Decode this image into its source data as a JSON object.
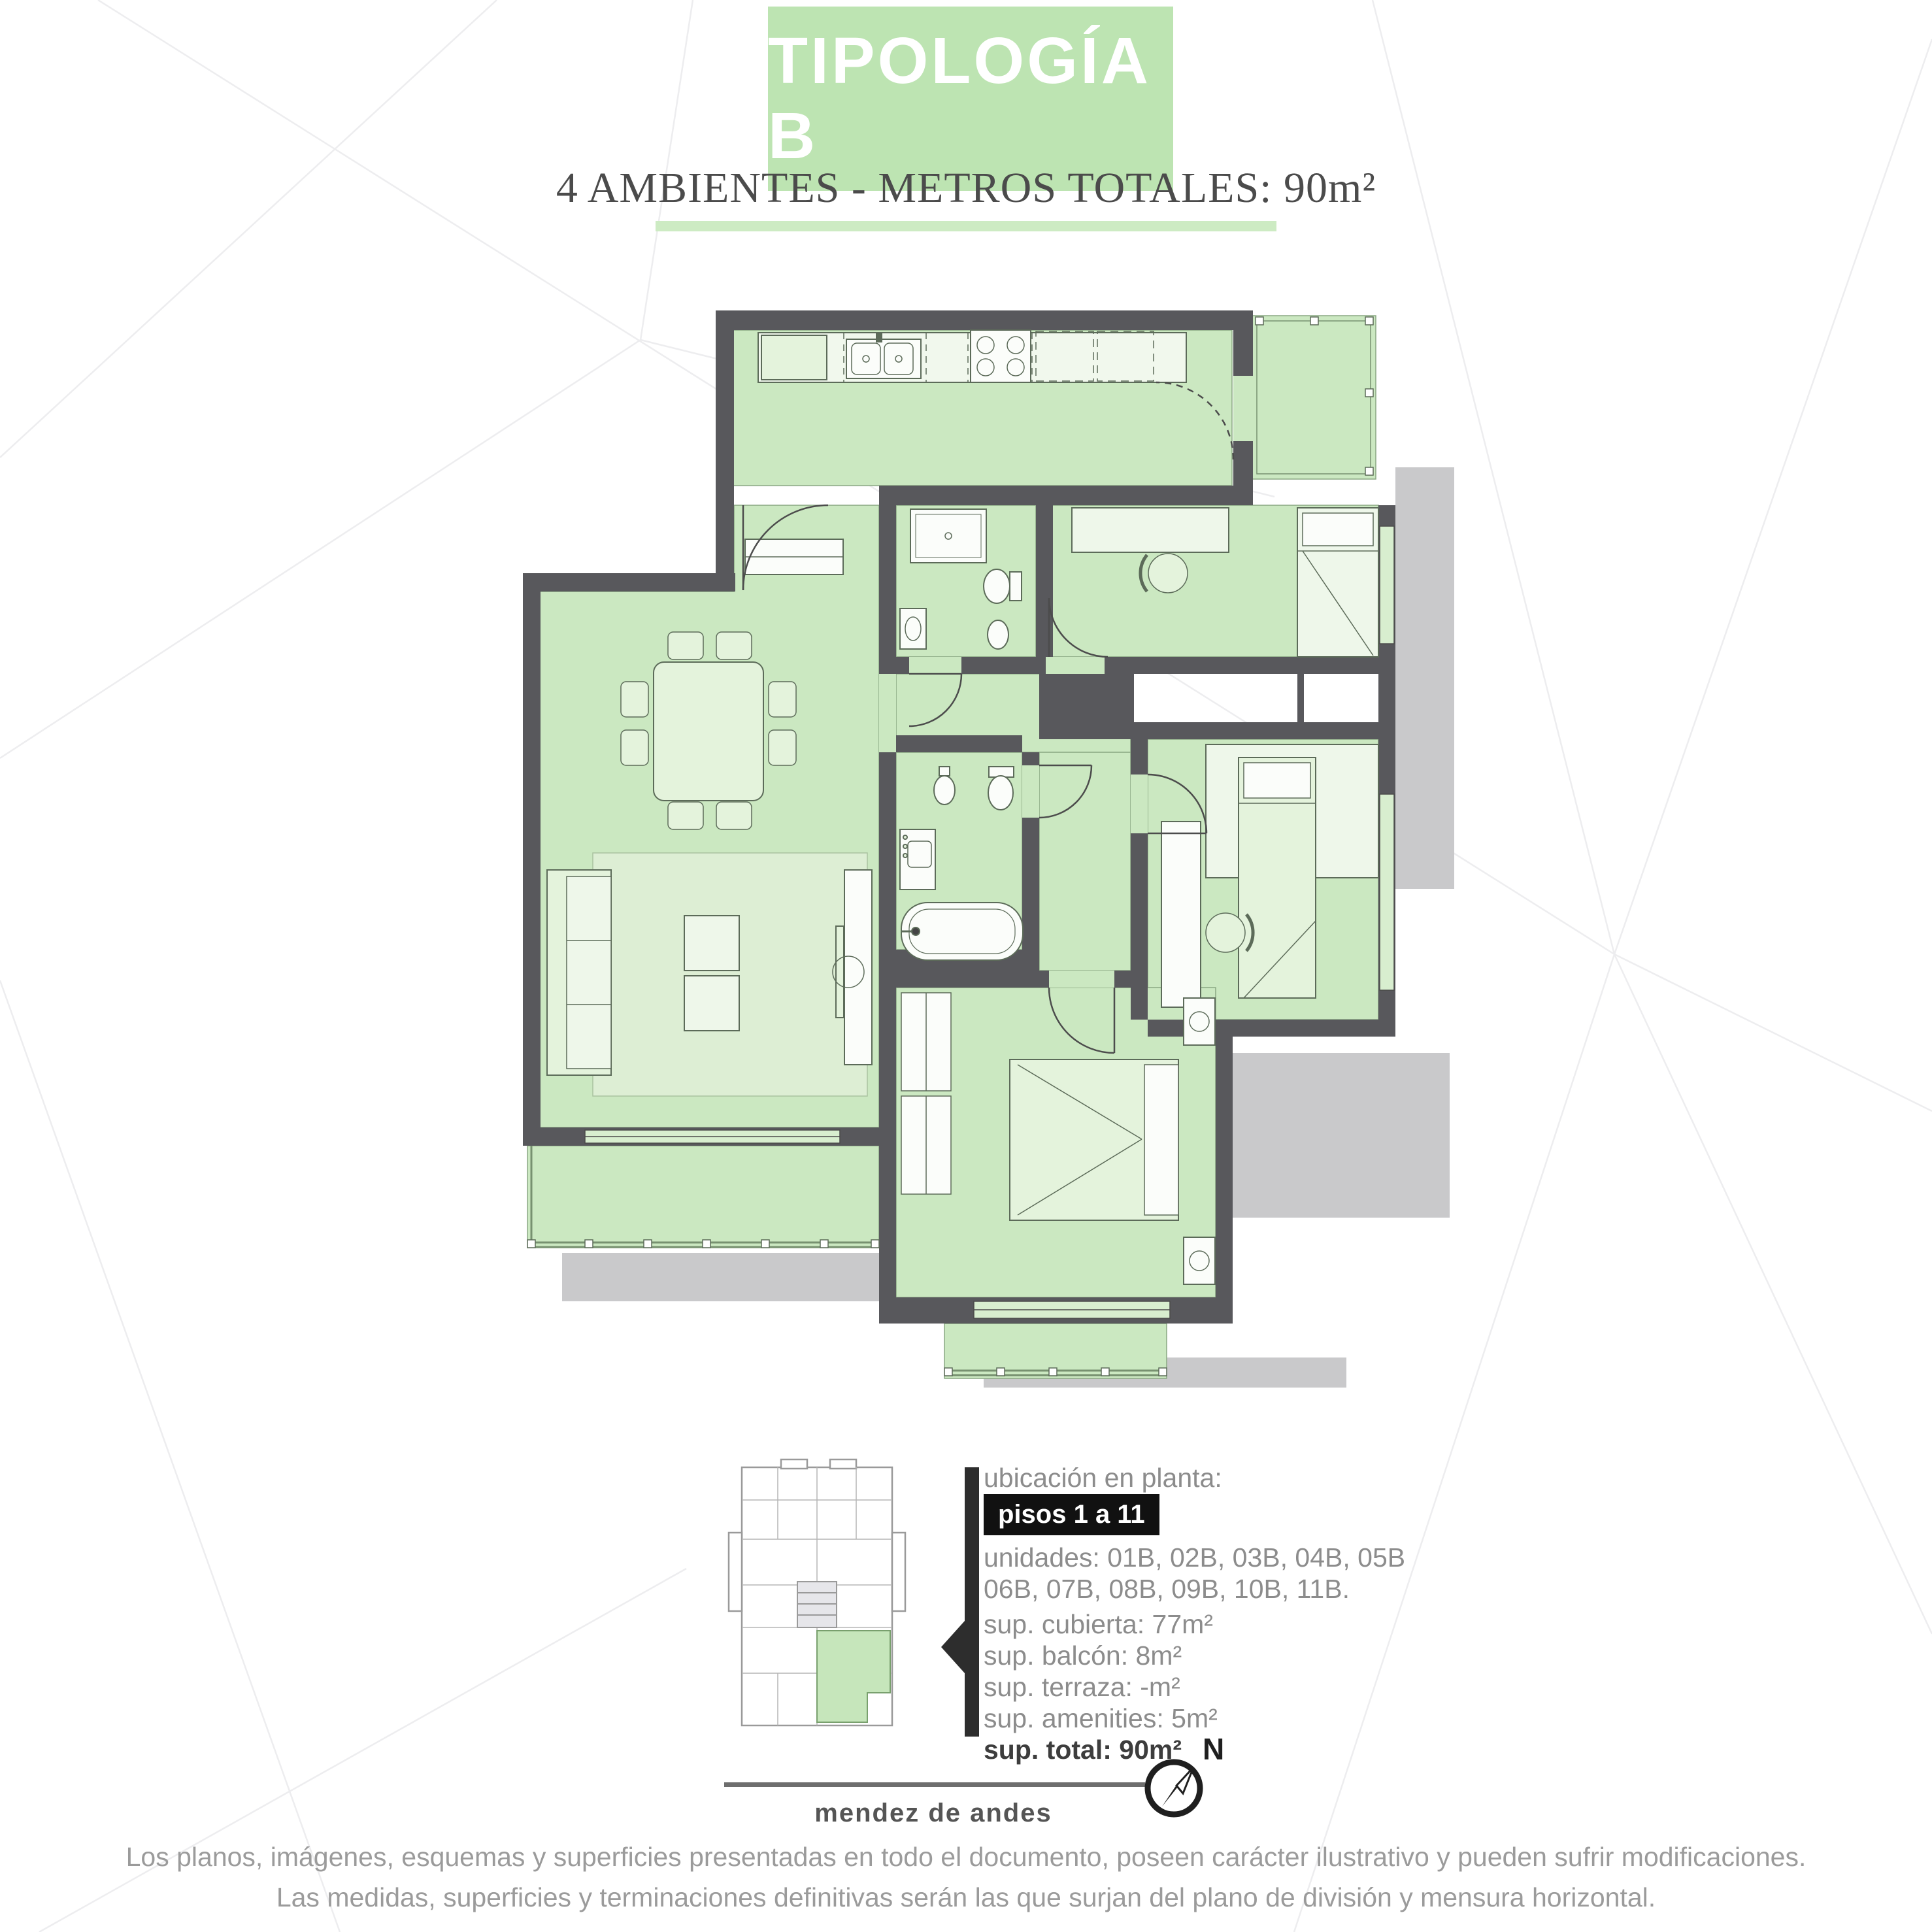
{
  "header": {
    "title": "TIPOLOGÍA B",
    "subtitle": "4 AMBIENTES - METROS TOTALES: 90m²"
  },
  "location": {
    "label": "ubicación en planta:",
    "floors_badge": "pisos 1 a 11",
    "units_line1": "unidades: 01B, 02B, 03B, 04B, 05B",
    "units_line2": "06B, 07B, 08B, 09B, 10B, 11B.",
    "surfaces": {
      "cubierta": "sup. cubierta: 77m²",
      "balcon": "sup. balcón: 8m²",
      "terraza": "sup. terraza: -m²",
      "amenities": "sup. amenities: 5m²",
      "total": "sup. total: 90m²"
    },
    "street_label": "mendez de andes",
    "compass_north_label": "N"
  },
  "disclaimer": {
    "line1": "Los planos, imágenes, esquemas y superficies presentadas en todo el documento, poseen carácter ilustrativo y pueden sufrir modificaciones.",
    "line2": "Las medidas, superficies y terminaciones definitivas serán las que surjan del plano de división y mensura horizontal."
  },
  "colors": {
    "accent_green": "#bde4b2",
    "underline_green": "#cdebc3",
    "room_green": "#cbe8c1",
    "furniture_green": "#e4f3dc",
    "wall_gray": "#58585c",
    "shadow_gray": "#c9c9cb",
    "badge_black": "#111111",
    "text_gray": "#8c8c8c"
  }
}
